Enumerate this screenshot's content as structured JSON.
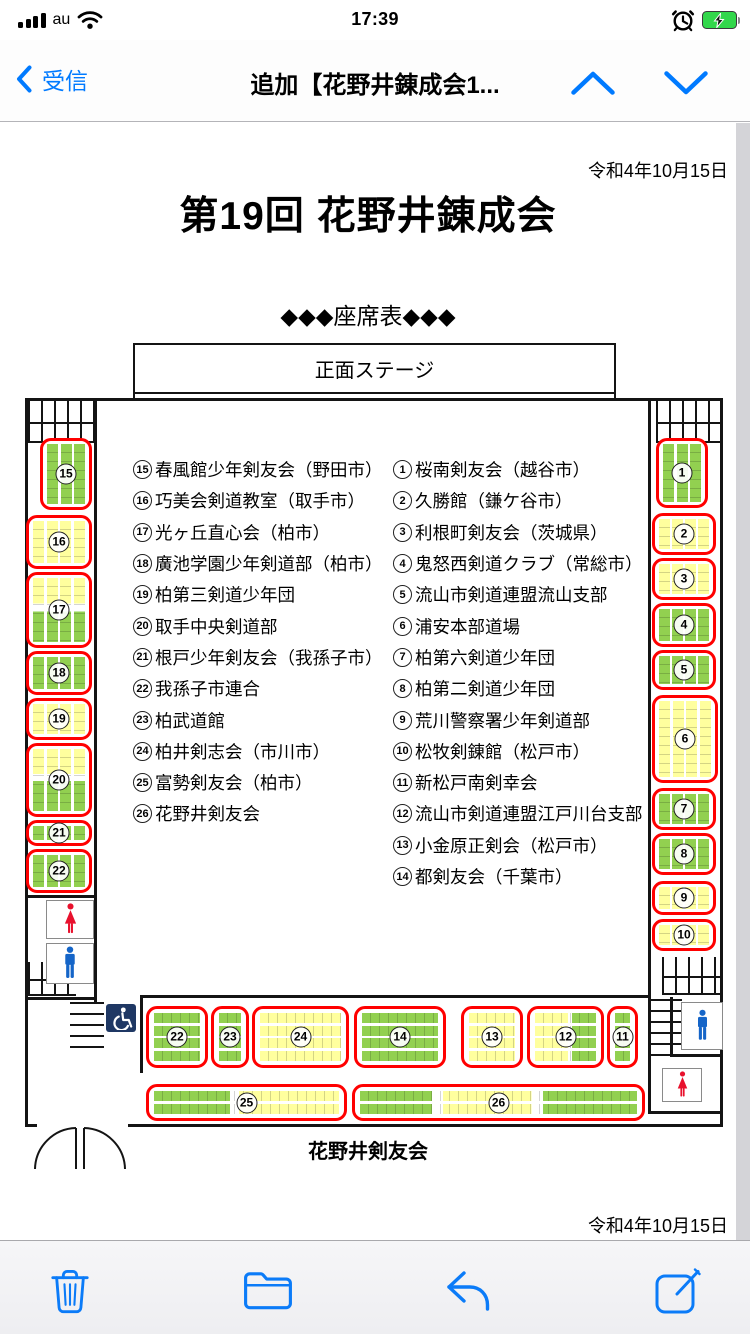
{
  "status_bar": {
    "carrier": "au",
    "time": "17:39",
    "icons": [
      "signal-bars-icon",
      "wifi-icon",
      "alarm-clock-icon",
      "battery-charging-icon"
    ],
    "battery_color": "#32d74b"
  },
  "nav_bar": {
    "back_label": "受信",
    "title": "追加【花野井錬成会1...",
    "accent": "#007aff",
    "icons": [
      "chevron-left-icon",
      "chevron-up-icon",
      "chevron-down-icon"
    ]
  },
  "document": {
    "date_top": "令和4年10月15日",
    "title": "第19回 花野井錬成会",
    "subtitle": "◆◆◆座席表◆◆◆",
    "stage_label": "正面ステージ",
    "footer_label": "花野井剣友会",
    "date_bottom": "令和4年10月15日",
    "legend_left": [
      {
        "n": "15",
        "name": "春風館少年剣友会（野田市）"
      },
      {
        "n": "16",
        "name": "巧美会剣道教室（取手市）"
      },
      {
        "n": "17",
        "name": "光ヶ丘直心会（柏市）"
      },
      {
        "n": "18",
        "name": "廣池学園少年剣道部（柏市）"
      },
      {
        "n": "19",
        "name": "柏第三剣道少年団"
      },
      {
        "n": "20",
        "name": "取手中央剣道部"
      },
      {
        "n": "21",
        "name": "根戸少年剣友会（我孫子市）"
      },
      {
        "n": "22",
        "name": "我孫子市連合"
      },
      {
        "n": "23",
        "name": "柏武道館"
      },
      {
        "n": "24",
        "name": "柏井剣志会（市川市）"
      },
      {
        "n": "25",
        "name": "富勢剣友会（柏市）"
      },
      {
        "n": "26",
        "name": "花野井剣友会"
      }
    ],
    "legend_right": [
      {
        "n": "1",
        "name": "桜南剣友会（越谷市）"
      },
      {
        "n": "2",
        "name": "久勝館（鎌ケ谷市）"
      },
      {
        "n": "3",
        "name": "利根町剣友会（茨城県）"
      },
      {
        "n": "4",
        "name": "鬼怒西剣道クラブ（常総市）"
      },
      {
        "n": "5",
        "name": "流山市剣道連盟流山支部"
      },
      {
        "n": "6",
        "name": "浦安本部道場"
      },
      {
        "n": "7",
        "name": "柏第六剣道少年団"
      },
      {
        "n": "8",
        "name": "柏第二剣道少年団"
      },
      {
        "n": "9",
        "name": "荒川警察署少年剣道部"
      },
      {
        "n": "10",
        "name": "松牧剣錬館（松戸市）"
      },
      {
        "n": "11",
        "name": "新松戸南剣幸会"
      },
      {
        "n": "12",
        "name": "流山市剣道連盟江戸川台支部"
      },
      {
        "n": "13",
        "name": "小金原正剣会（松戸市）"
      },
      {
        "n": "14",
        "name": "都剣友会（千葉市）"
      }
    ],
    "seat_colors": {
      "green": "#92d050",
      "yellow": "#ffff9e",
      "outline": "#ff0000"
    },
    "plan_icons": [
      "wheelchair-icon",
      "women-restroom-icon",
      "men-restroom-icon",
      "stairs-icon",
      "door-swing-icon"
    ],
    "blocks": [
      {
        "label": "15",
        "x": 40,
        "y": 315,
        "w": 52,
        "h": 72,
        "o": "v",
        "n": 3,
        "fill": "green"
      },
      {
        "label": "16",
        "x": 26,
        "y": 392,
        "w": 66,
        "h": 54,
        "o": "v",
        "n": 4,
        "fill": "yellow"
      },
      {
        "label": "17",
        "x": 26,
        "y": 449,
        "w": 66,
        "h": 76,
        "o": "v",
        "n": 4,
        "fill": "yg"
      },
      {
        "label": "18",
        "x": 26,
        "y": 528,
        "w": 66,
        "h": 44,
        "o": "v",
        "n": 4,
        "fill": "green"
      },
      {
        "label": "19",
        "x": 26,
        "y": 575,
        "w": 66,
        "h": 42,
        "o": "v",
        "n": 4,
        "fill": "yellow"
      },
      {
        "label": "20",
        "x": 26,
        "y": 620,
        "w": 66,
        "h": 74,
        "o": "v",
        "n": 4,
        "fill": "yg"
      },
      {
        "label": "21",
        "x": 26,
        "y": 697,
        "w": 66,
        "h": 26,
        "o": "v",
        "n": 4,
        "fill": "green"
      },
      {
        "label": "22",
        "x": 26,
        "y": 726,
        "w": 66,
        "h": 44,
        "o": "v",
        "n": 4,
        "fill": "green"
      },
      {
        "label": "1",
        "x": 656,
        "y": 315,
        "w": 52,
        "h": 70,
        "o": "v",
        "n": 3,
        "fill": "green"
      },
      {
        "label": "2",
        "x": 652,
        "y": 390,
        "w": 64,
        "h": 42,
        "o": "v",
        "n": 4,
        "fill": "yellow"
      },
      {
        "label": "3",
        "x": 652,
        "y": 435,
        "w": 64,
        "h": 42,
        "o": "v",
        "n": 4,
        "fill": "yellow"
      },
      {
        "label": "4",
        "x": 652,
        "y": 480,
        "w": 64,
        "h": 44,
        "o": "v",
        "n": 4,
        "fill": "green"
      },
      {
        "label": "5",
        "x": 652,
        "y": 527,
        "w": 64,
        "h": 40,
        "o": "v",
        "n": 4,
        "fill": "green"
      },
      {
        "label": "6",
        "x": 652,
        "y": 572,
        "w": 66,
        "h": 88,
        "o": "v",
        "n": 4,
        "fill": "yellow"
      },
      {
        "label": "7",
        "x": 652,
        "y": 665,
        "w": 64,
        "h": 42,
        "o": "v",
        "n": 4,
        "fill": "green"
      },
      {
        "label": "8",
        "x": 652,
        "y": 710,
        "w": 64,
        "h": 42,
        "o": "v",
        "n": 4,
        "fill": "green"
      },
      {
        "label": "9",
        "x": 652,
        "y": 758,
        "w": 64,
        "h": 34,
        "o": "v",
        "n": 4,
        "fill": "yellow"
      },
      {
        "label": "10",
        "x": 652,
        "y": 796,
        "w": 64,
        "h": 32,
        "o": "v",
        "n": 4,
        "fill": "yellow"
      },
      {
        "label": "22",
        "x": 146,
        "y": 883,
        "w": 62,
        "h": 62,
        "o": "h",
        "n": 4,
        "fill": "green"
      },
      {
        "label": "23",
        "x": 211,
        "y": 883,
        "w": 38,
        "h": 62,
        "o": "h",
        "n": 4,
        "fill": "green"
      },
      {
        "label": "24",
        "x": 252,
        "y": 883,
        "w": 97,
        "h": 62,
        "o": "h",
        "n": 4,
        "fill": "yellow"
      },
      {
        "label": "14",
        "x": 354,
        "y": 883,
        "w": 92,
        "h": 62,
        "o": "h",
        "n": 4,
        "fill": "green"
      },
      {
        "label": "13",
        "x": 461,
        "y": 883,
        "w": 62,
        "h": 62,
        "o": "h",
        "n": 4,
        "fill": "yellow"
      },
      {
        "label": "12",
        "x": 527,
        "y": 883,
        "w": 77,
        "h": 62,
        "o": "h",
        "n": 4,
        "fill": "yg_h"
      },
      {
        "label": "11",
        "x": 607,
        "y": 883,
        "w": 31,
        "h": 62,
        "o": "h",
        "n": 4,
        "fill": "green"
      },
      {
        "label": "25",
        "x": 146,
        "y": 961,
        "w": 201,
        "h": 37,
        "o": "h",
        "n": 2,
        "fill": "gy_h"
      },
      {
        "label": "26",
        "x": 352,
        "y": 961,
        "w": 293,
        "h": 37,
        "o": "h",
        "n": 2,
        "fill": "gyg_h"
      }
    ]
  },
  "toolbar": {
    "accent": "#0b7bf8",
    "icons": [
      "trash-icon",
      "folder-icon",
      "reply-icon",
      "compose-icon"
    ]
  }
}
